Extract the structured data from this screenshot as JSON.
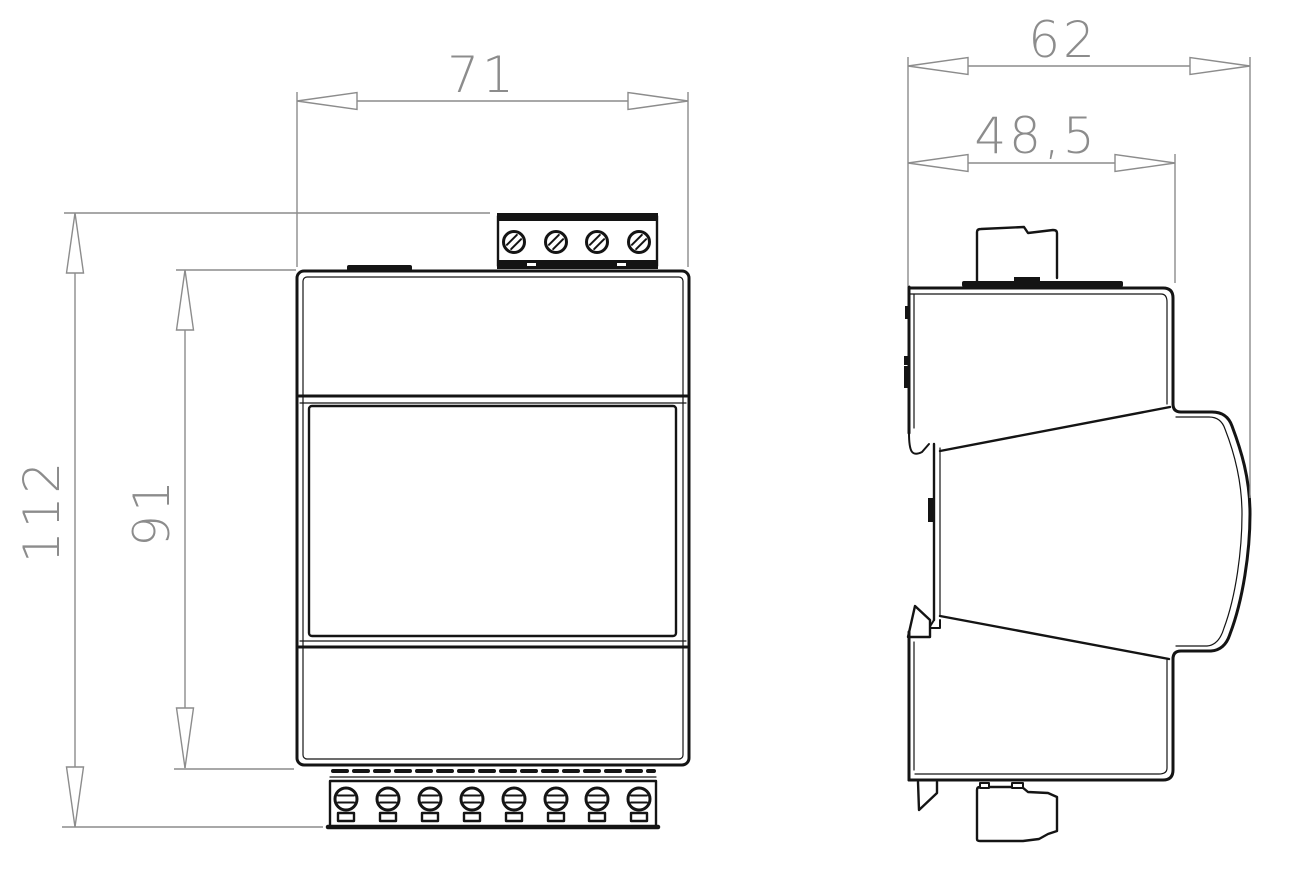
{
  "drawing": {
    "type": "technical-dimension-drawing",
    "subject": "DIN-rail module, front and side views",
    "dimensions": {
      "front_width": {
        "value": "71"
      },
      "total_height": {
        "value": "112"
      },
      "body_height": {
        "value": "91"
      },
      "side_depth": {
        "value": "62"
      },
      "body_depth": {
        "value": "48,5"
      }
    },
    "colors": {
      "line": "#141414",
      "dimension": "#8c8c8c",
      "background": "#ffffff"
    }
  }
}
